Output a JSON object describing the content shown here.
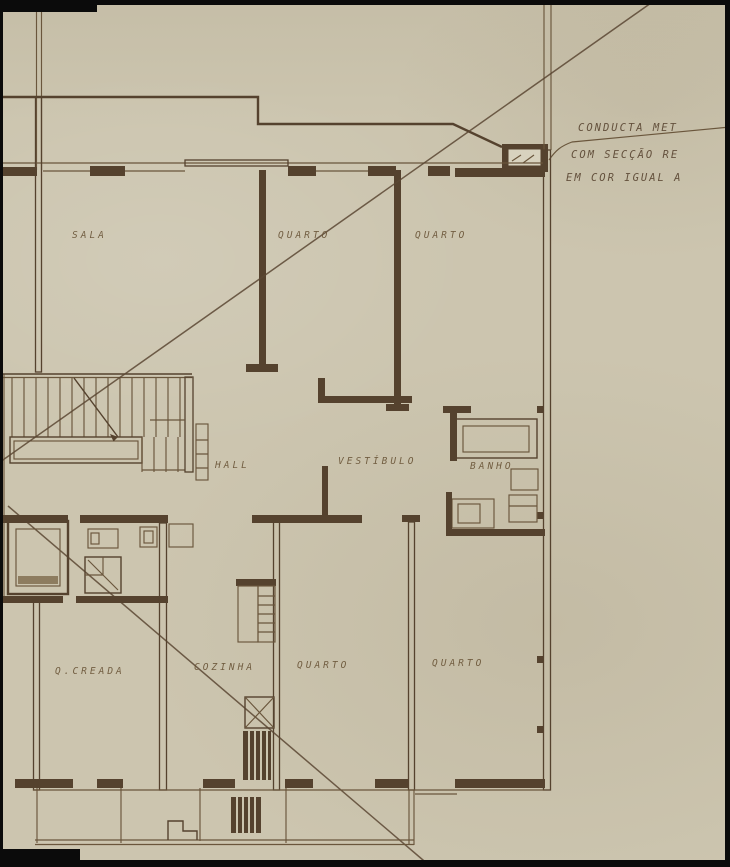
{
  "document": {
    "kind": "hand-drawn architectural floor plan on aged sepia paper",
    "language": "Portuguese"
  },
  "room_labels": {
    "sala": "SALA",
    "quarto_top_left": "QUARTO",
    "quarto_top_right": "QUARTO",
    "hall": "HALL",
    "vestibulo": "VESTÍBULO",
    "banho": "BANHO",
    "quarto_creada": "Q.CREADA",
    "cozinha": "COZINHA",
    "quarto_bottom_left": "QUARTO",
    "quarto_bottom_right": "QUARTO"
  },
  "annotation": {
    "line1": "CONDUCTA MET",
    "line2": "COM SECÇÃO RE",
    "line3": "EM COR IGUAL A"
  },
  "colors": {
    "paper": "#ccc5af",
    "ink_dark": "#55422e",
    "ink_light": "#6a563c",
    "margin_black": "#0b0b0b"
  }
}
